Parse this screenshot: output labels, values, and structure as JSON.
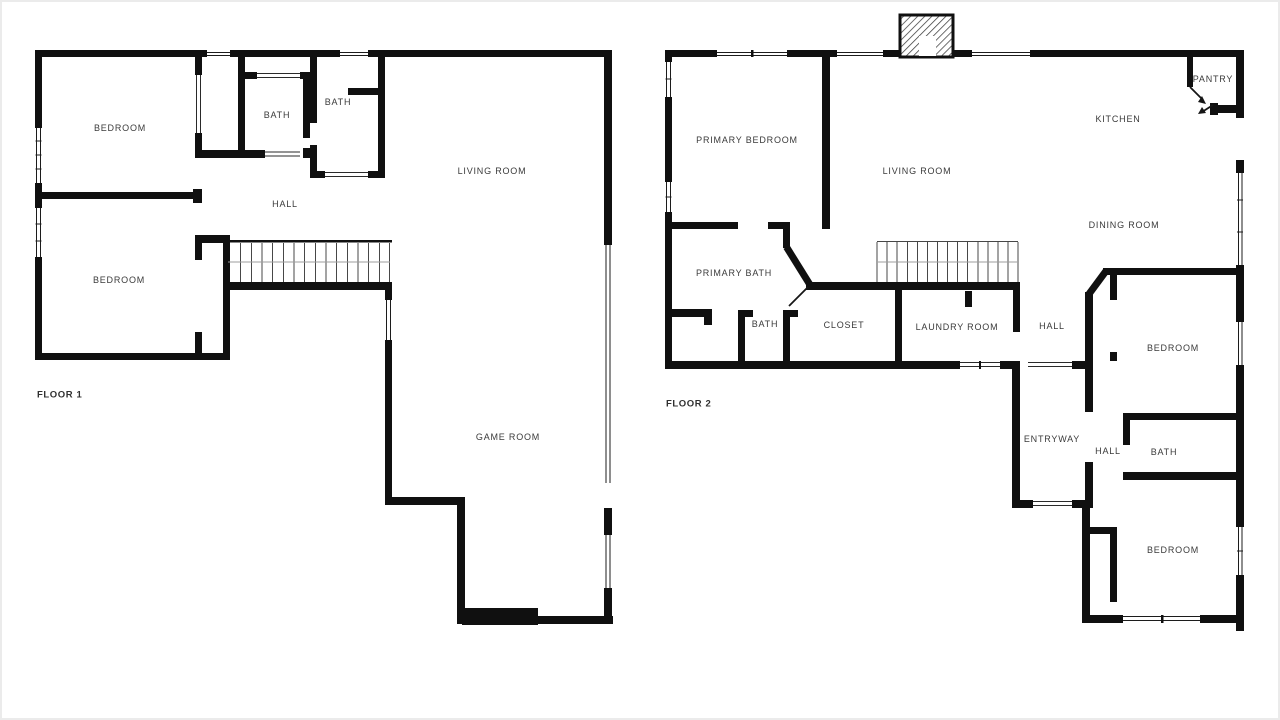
{
  "theme": {
    "background": "#ffffff",
    "wall": "#101010",
    "label_color": "#3a3a3a",
    "stair_line": "#474747",
    "window_line": "#1c1c1c",
    "frame": "#ebebeb"
  },
  "floors": [
    {
      "label": "FLOOR 1",
      "rooms": [
        {
          "name": "BEDROOM"
        },
        {
          "name": "BATH"
        },
        {
          "name": "BATH"
        },
        {
          "name": "LIVING ROOM"
        },
        {
          "name": "HALL"
        },
        {
          "name": "BEDROOM"
        },
        {
          "name": "GAME ROOM"
        }
      ]
    },
    {
      "label": "FLOOR 2",
      "rooms": [
        {
          "name": "PRIMARY BEDROOM"
        },
        {
          "name": "LIVING ROOM"
        },
        {
          "name": "KITCHEN"
        },
        {
          "name": "PANTRY"
        },
        {
          "name": "DINING ROOM"
        },
        {
          "name": "PRIMARY BATH"
        },
        {
          "name": "BATH"
        },
        {
          "name": "CLOSET"
        },
        {
          "name": "LAUNDRY ROOM"
        },
        {
          "name": "HALL"
        },
        {
          "name": "BEDROOM"
        },
        {
          "name": "ENTRYWAY"
        },
        {
          "name": "HALL"
        },
        {
          "name": "BATH"
        },
        {
          "name": "BEDROOM"
        }
      ]
    }
  ]
}
